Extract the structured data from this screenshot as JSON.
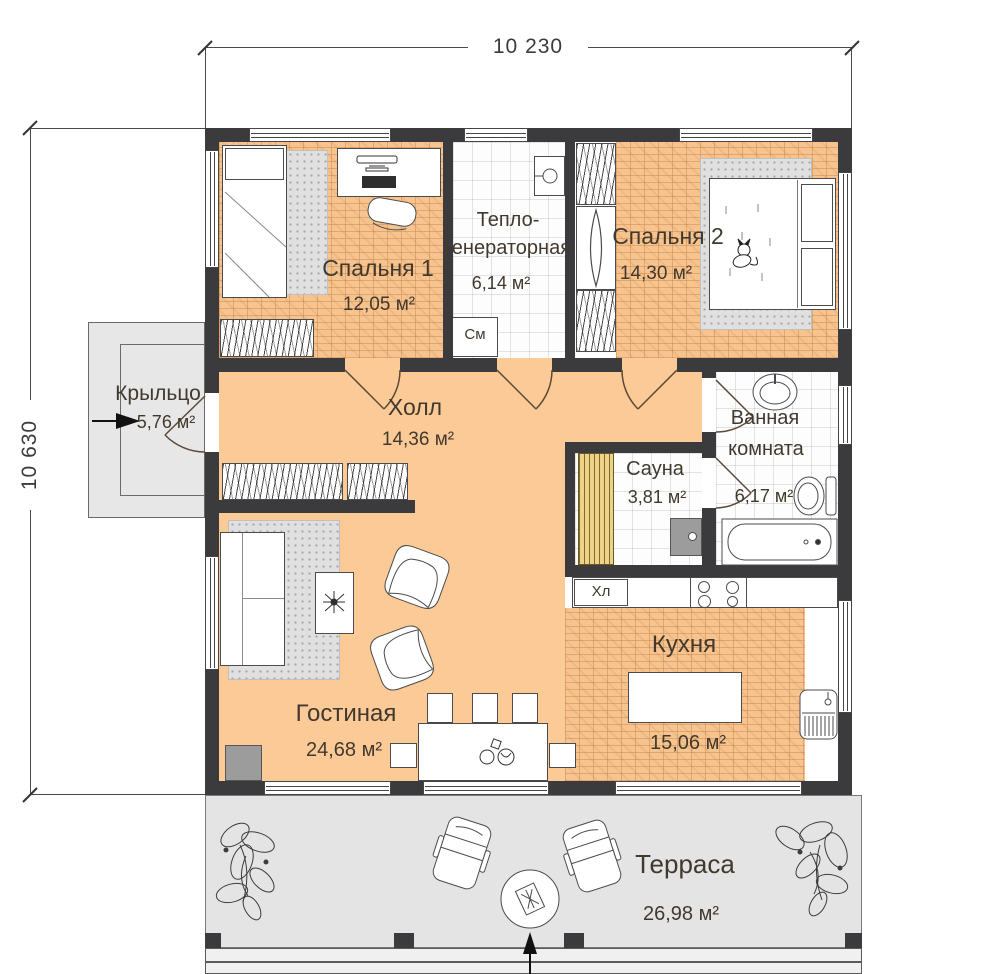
{
  "dimensions": {
    "width": "10 230",
    "height": "10 630"
  },
  "rooms": {
    "bedroom1": {
      "name": "Спальня 1",
      "area": "12,05 м²"
    },
    "heatroom": {
      "name_line1": "Тепло-",
      "name_line2": "генераторная",
      "area": "6,14 м²"
    },
    "bedroom2": {
      "name": "Спальня 2",
      "area": "14,30 м²"
    },
    "porch": {
      "name": "Крыльцо",
      "area": "5,76 м²"
    },
    "hall": {
      "name": "Холл",
      "area": "14,36 м²"
    },
    "bathroom": {
      "name_line1": "Ванная",
      "name_line2": "комната",
      "area": "6,17 м²"
    },
    "sauna": {
      "name": "Сауна",
      "area": "3,81 м²"
    },
    "living": {
      "name": "Гостиная",
      "area": "24,68 м²"
    },
    "kitchen": {
      "name": "Кухня",
      "area": "15,06 м²"
    },
    "terrace": {
      "name": "Терраса",
      "area": "26,98 м²"
    }
  },
  "appliances": {
    "washing_machine": "См",
    "fridge": "Хл"
  },
  "colors": {
    "wall": "#3b3b3d",
    "floor_orange": "#fbca96",
    "parquet": "#f7c48f",
    "terrace": "#e4e4e4",
    "sauna_wood": "#edd289",
    "text": "#42392e"
  }
}
